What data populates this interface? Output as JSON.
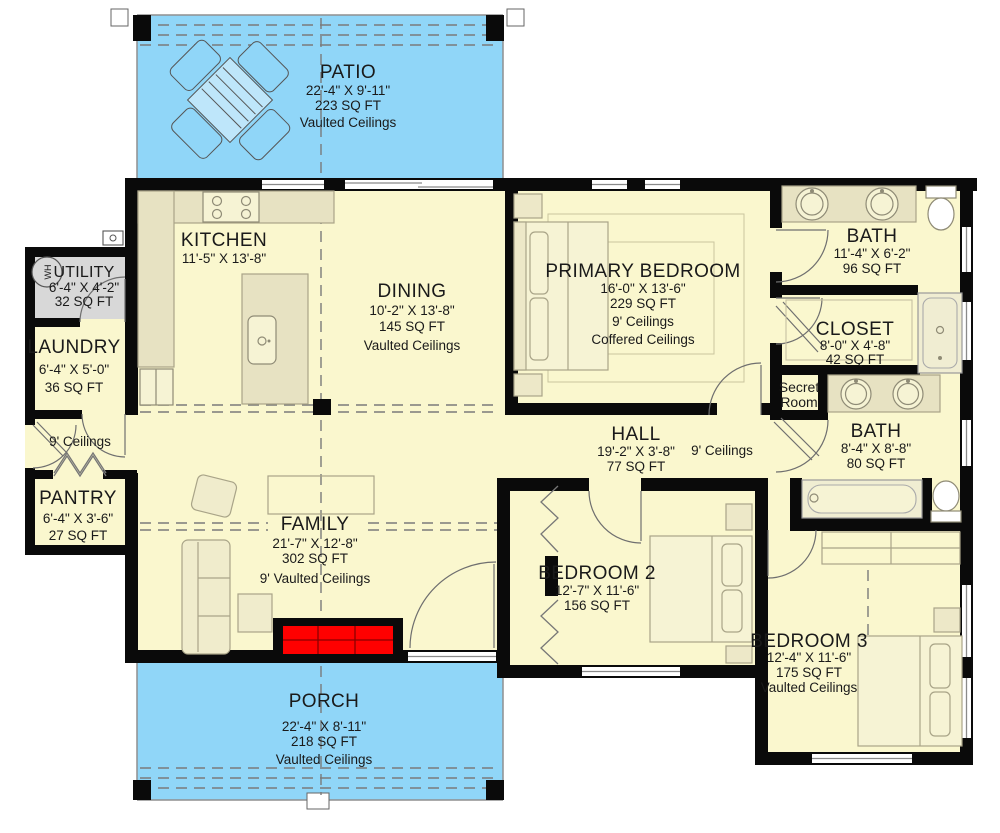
{
  "title": "House Floor Plan",
  "colors": {
    "floor": "#FAF7CE",
    "outdoor": "#90D6F8",
    "utility_floor": "#D8D8D8",
    "counter": "#E7E2C2",
    "wall": "#0A0A0A",
    "fireplace_red": "#FF0000"
  },
  "rooms": {
    "patio": {
      "name": "PATIO",
      "dims": "22'-4\" X 9'-11\"",
      "area": "223 SQ FT",
      "note": "Vaulted Ceilings"
    },
    "kitchen": {
      "name": "KITCHEN",
      "dims": "11'-5\" X 13'-8\""
    },
    "utility": {
      "name": "UTILITY",
      "dims": "6'-4\" X 4'-2\"",
      "area": "32 SQ FT"
    },
    "laundry": {
      "name": "LAUNDRY",
      "dims": "6'-4\" X 5'-0\"",
      "area": "36 SQ FT"
    },
    "mudroom": {
      "note": "9' Ceilings"
    },
    "pantry": {
      "name": "PANTRY",
      "dims": "6'-4\" X 3'-6\"",
      "area": "27 SQ FT"
    },
    "dining": {
      "name": "DINING",
      "dims": "10'-2\" X 13'-8\"",
      "area": "145 SQ FT",
      "note": "Vaulted Ceilings"
    },
    "family": {
      "name": "FAMILY",
      "dims": "21'-7\" X 12'-8\"",
      "area": "302 SQ FT",
      "note": "9' Vaulted Ceilings"
    },
    "primary": {
      "name": "PRIMARY BEDROOM",
      "dims": "16'-0\" X 13'-6\"",
      "area": "229 SQ FT",
      "note": "9' Ceilings",
      "note2": "Coffered Ceilings"
    },
    "bath1": {
      "name": "BATH",
      "dims": "11'-4\" X 6'-2\"",
      "area": "96 SQ FT"
    },
    "closet": {
      "name": "CLOSET",
      "dims": "8'-0\" X 4'-8\"",
      "area": "42 SQ FT"
    },
    "secret": {
      "line1": "Secret",
      "line2": "Room"
    },
    "bath2": {
      "name": "BATH",
      "dims": "8'-4\" X 8'-8\"",
      "area": "80 SQ FT"
    },
    "hall": {
      "name": "HALL",
      "dims": "19'-2\" X 3'-8\"",
      "area": "77 SQ FT",
      "note": "9' Ceilings"
    },
    "bedroom2": {
      "name": "BEDROOM 2",
      "dims": "12'-7\" X 11'-6\"",
      "area": "156 SQ FT"
    },
    "bedroom3": {
      "name": "BEDROOM 3",
      "dims": "12'-4\" X 11'-6\"",
      "area": "175 SQ FT",
      "note": "Vaulted Ceilings"
    },
    "porch": {
      "name": "PORCH",
      "dims": "22'-4\" X 8'-11\"",
      "area": "218 SQ FT",
      "note": "Vaulted Ceilings"
    }
  },
  "labels": {
    "water_heater": "WH"
  }
}
